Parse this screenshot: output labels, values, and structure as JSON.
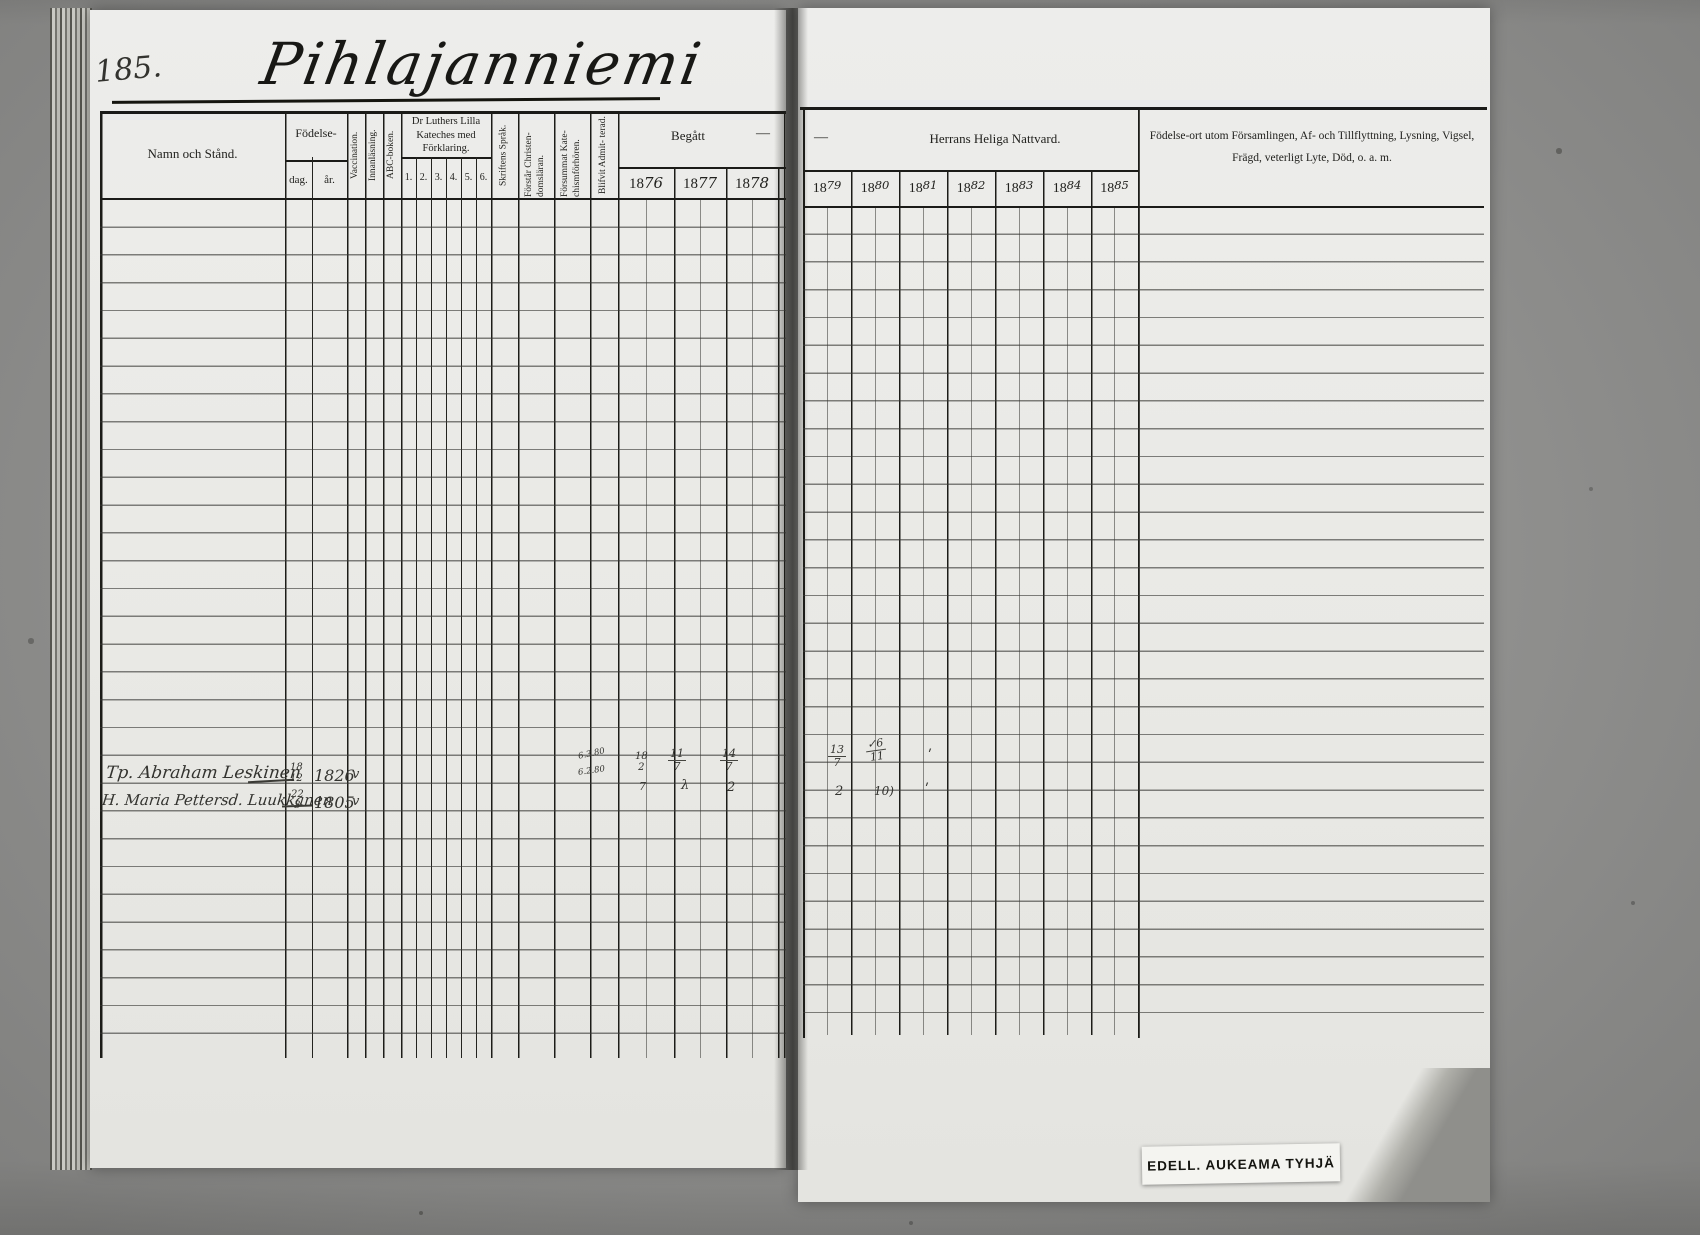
{
  "page": {
    "number": "185.",
    "title": "Pihlajanniemi"
  },
  "left_table": {
    "header": {
      "name_col": "Namn och Stånd.",
      "birth_group": "Födelse-",
      "birth_day": "dag.",
      "birth_year": "år.",
      "vaccination": "Vaccination.",
      "reading": "Innanläsning.",
      "abc_book": "ABC-boken.",
      "catechism_title": "Dr Luthers Lilla Kateches med Förklaring.",
      "catechism_cols": [
        "1.",
        "2.",
        "3.",
        "4.",
        "5.",
        "6."
      ],
      "script_language": "Skriftens Språk.",
      "understands_christianity": "Förstår Christen- domsläran.",
      "missed_exams": "Försummat Kate- chismförhören.",
      "admitted": "Blifvit Admit- terad.",
      "begatt": "Begått",
      "begatt_dash": "—",
      "years": [
        {
          "prefix": "18",
          "suffix": "76"
        },
        {
          "prefix": "18",
          "suffix": "77"
        },
        {
          "prefix": "18",
          "suffix": "78"
        }
      ]
    }
  },
  "right_table": {
    "header": {
      "dash": "—",
      "communion": "Herrans Heliga Nattvard.",
      "years": [
        {
          "prefix": "18",
          "suffix": "79"
        },
        {
          "prefix": "18",
          "suffix": "80"
        },
        {
          "prefix": "18",
          "suffix": "81"
        },
        {
          "prefix": "18",
          "suffix": "82"
        },
        {
          "prefix": "18",
          "suffix": "83"
        },
        {
          "prefix": "18",
          "suffix": "84"
        },
        {
          "prefix": "18",
          "suffix": "85"
        }
      ],
      "notes_line1": "Födelse-ort utom Församlingen, Af- och Tillflyttning, Lysning, Vigsel,",
      "notes_line2": "Frägd, veterligt Lyte, Död, o. a. m."
    }
  },
  "entries": [
    {
      "name": "Tp. Abraham Leskinen",
      "birth_day_num": "18",
      "birth_day_den": "12",
      "birth_year": "1826",
      "vaccinated": "v"
    },
    {
      "name": "H. Maria Pettersd. Luukkanen",
      "birth_day_num": "22",
      "birth_day_den": "3",
      "birth_year": "1805",
      "vaccinated": "v"
    }
  ],
  "marks": {
    "admitted_note1": "6.3.80",
    "admitted_note2": "6.2.80",
    "y1876": {
      "num": "18",
      "den": "2",
      "below": "7"
    },
    "y1877": {
      "num": "11",
      "den": "7",
      "below": "λ"
    },
    "y1878": {
      "num": "14",
      "den": "7",
      "below": "2"
    },
    "y1879": {
      "num": "13",
      "den": "7",
      "below": "2"
    },
    "y1880": {
      "num": "✓6",
      "den": "11",
      "below": "10)"
    },
    "y1881": {
      "tick_top": "ʹ",
      "tick_bottom": "ʹ"
    }
  },
  "stamp": {
    "label": "EDELL. AUKEAMA TYHJÄ"
  }
}
